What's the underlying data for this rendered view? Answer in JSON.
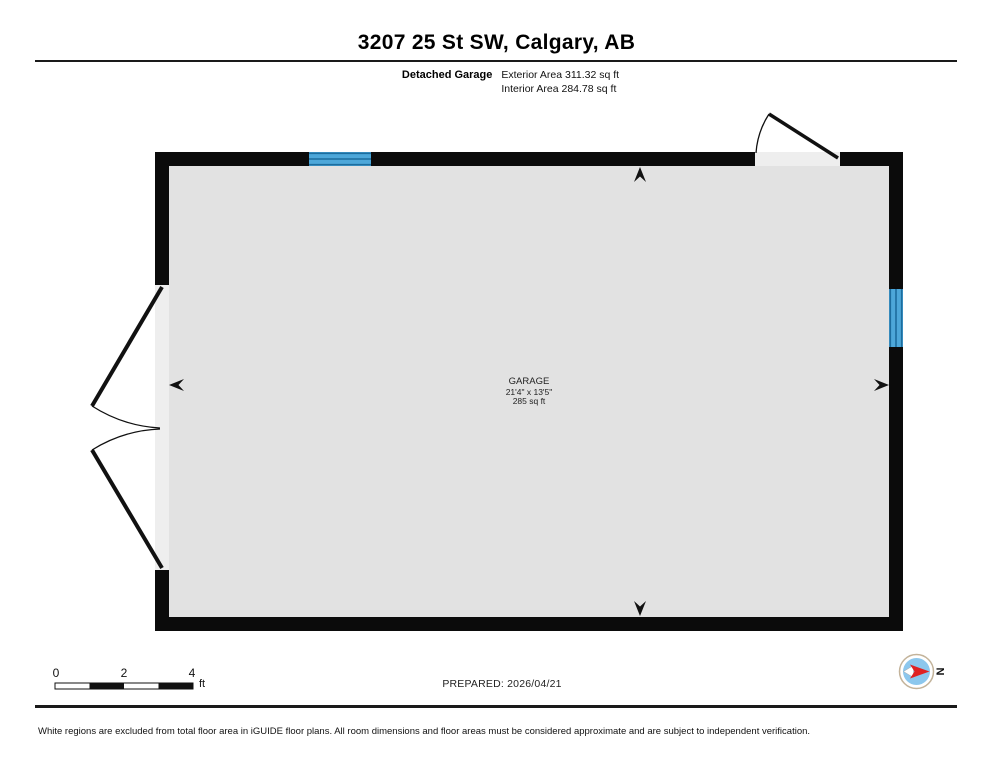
{
  "header": {
    "title": "3207 25 St SW, Calgary, AB",
    "unit_label": "Detached Garage",
    "exterior_area": "Exterior Area 311.32 sq ft",
    "interior_area": "Interior Area 284.78 sq ft"
  },
  "room": {
    "name": "GARAGE",
    "dimensions": "21'4\" x 13'5\"",
    "area": "285 sq ft"
  },
  "scale_bar": {
    "ticks": [
      "0",
      "2",
      "4"
    ],
    "unit": "ft"
  },
  "footer": {
    "prepared": "PREPARED: 2026/04/21",
    "compass_north": "N",
    "disclaimer": "White regions are excluded from total floor area in iGUIDE floor plans. All room dimensions and floor areas must be considered approximate and are subject to independent verification."
  },
  "colors": {
    "wall": "#0b0b0b",
    "interior": "#e2e2e2",
    "opening": "#eeeeee",
    "window_blue": "#4da7d9",
    "window_line": "#1d6d9e",
    "compass_blue": "#8cc7ed",
    "compass_red": "#e02121",
    "compass_ring": "#c3b39a"
  }
}
